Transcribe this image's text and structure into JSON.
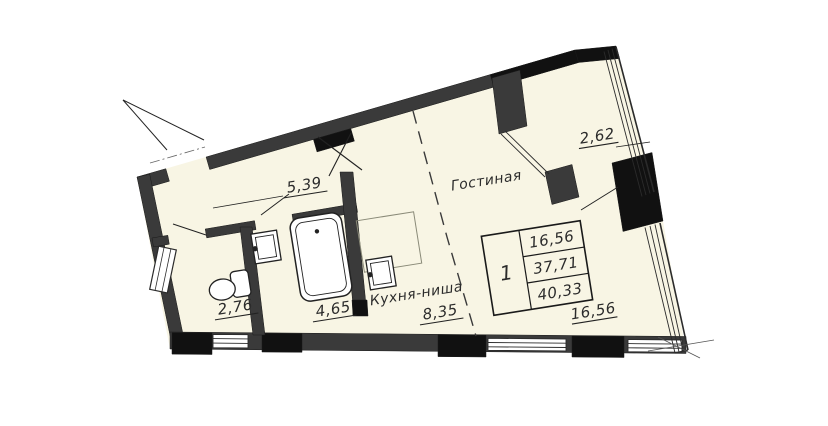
{
  "floor_plan": {
    "colors": {
      "background": "#ffffff",
      "floor": "#f8f5e4",
      "wall": "#3a3a3a",
      "wall_dark": "#111111",
      "line": "#2b2b2b"
    },
    "rooms": [
      {
        "key": "hallway",
        "name": "",
        "area": "5,39"
      },
      {
        "key": "wc",
        "name": "",
        "area": "2,76"
      },
      {
        "key": "bathroom",
        "name": "",
        "area": "4,65"
      },
      {
        "key": "kitchen_niche",
        "name": "Кухня-ниша",
        "area": "8,35"
      },
      {
        "key": "living_room",
        "name": "Гостиная",
        "area": "16,56"
      },
      {
        "key": "balcony",
        "name": "",
        "area": "2,62"
      }
    ],
    "info_table": {
      "rooms_count": "1",
      "values": [
        "16,56",
        "37,71",
        "40,33"
      ]
    }
  }
}
